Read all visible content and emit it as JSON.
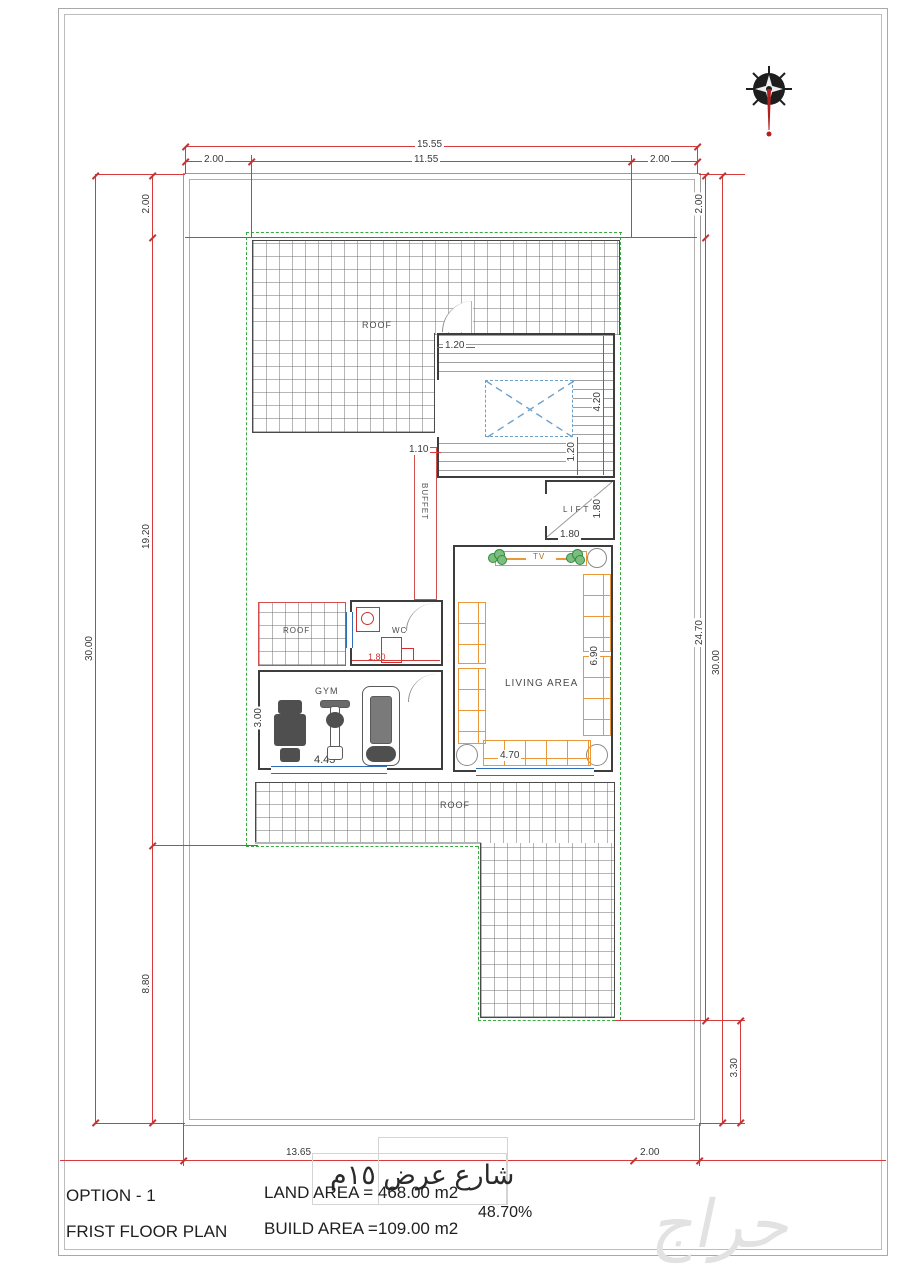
{
  "page": {
    "street_label": "شارع عرض ١٥م",
    "watermark": "حراج"
  },
  "title_block": {
    "option": "OPTION - 1",
    "plan_name": "FRIST FLOOR PLAN",
    "land_area": "LAND AREA =  468.00 m2",
    "build_area": "BUILD AREA =109.00 m2",
    "coverage": "48.70%"
  },
  "rooms": {
    "roof_top": "ROOF",
    "roof_small": "ROOF",
    "roof_bottom": "ROOF",
    "buffet": "BUFFET",
    "lift": "LIFT",
    "tv": "TV",
    "living": "LIVING AREA",
    "gym": "GYM",
    "wc": "WC"
  },
  "dims": {
    "top_total": "15.55",
    "top_left": "2.00",
    "top_mid": "11.55",
    "top_right": "2.00",
    "left_setback": "2.00",
    "left_mid": "19.20",
    "left_total": "30.00",
    "left_bottom": "8.80",
    "right_setback": "2.00",
    "right_inner": "24.70",
    "right_total": "30.00",
    "right_bottom": "3.30",
    "bottom_main": "13.65",
    "bottom_right": "2.00",
    "stair_door": "1.20",
    "stair_h": "4.20",
    "stair_w": "1.20",
    "corridor": "1.10",
    "lift_h": "1.80",
    "lift_w": "1.80",
    "wc_w": "1.80",
    "living_h": "6.90",
    "living_w": "4.70",
    "gym_h": "3.00",
    "gym_w": "4.45"
  },
  "colors": {
    "dimension_red": "#d63a3a",
    "boundary_green": "#3aa843",
    "window_blue": "#2f6fb5",
    "furniture_orange": "#e8973a",
    "fixture_red": "#d23030",
    "compass_red": "#c22222"
  }
}
